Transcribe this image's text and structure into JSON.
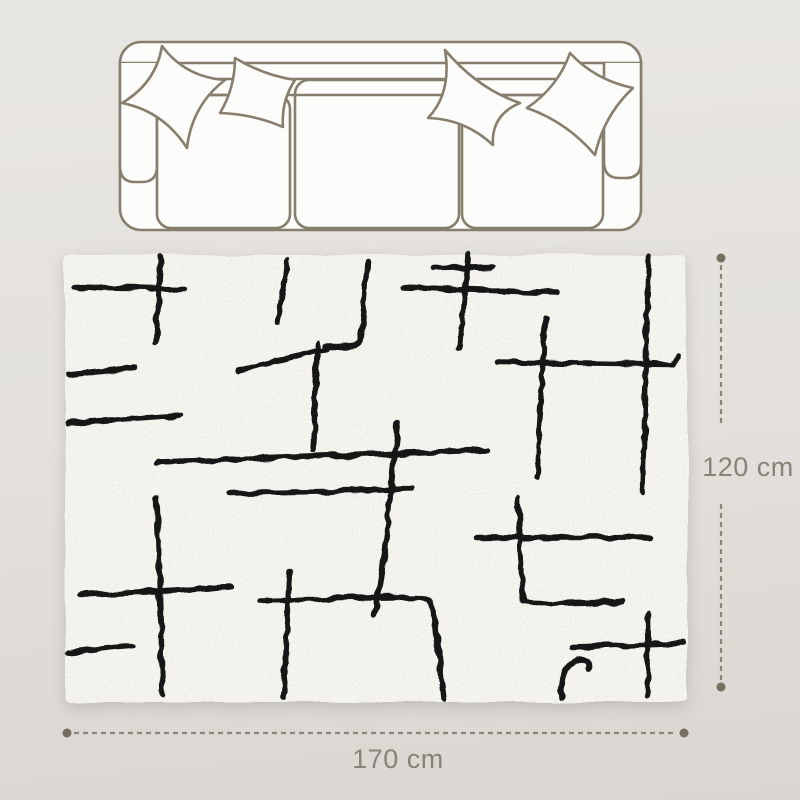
{
  "illustrations": {
    "sofa": "three-seat sofa top view with four pillows",
    "rug": "cream shag rug with black abstract line pattern"
  },
  "dimensions": {
    "width": {
      "label": "170 cm"
    },
    "height": {
      "label": "120 cm"
    }
  },
  "colors": {
    "background_top": "#e9e7e3",
    "background_bottom": "#d9d5d0",
    "line_art": "#877f6d",
    "illustration_fill": "#fcfcfa",
    "dimension_line": "#8b8477",
    "dimension_dot": "#756e61",
    "dimension_text": "#8a8277",
    "rug_base": "#f7f5f0",
    "rug_pattern": "#161616"
  }
}
